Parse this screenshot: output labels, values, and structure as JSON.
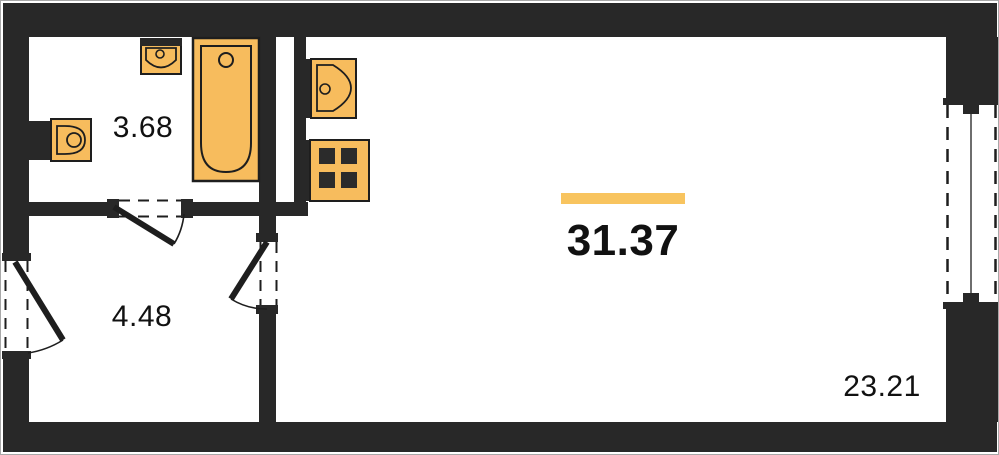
{
  "plan": {
    "name": "studio-apartment-floor-plan",
    "colors": {
      "wall": "#282828",
      "fixture_fill": "#F7BC5D",
      "fixture_stroke": "#1E1E1E",
      "accent_bar": "#F8C45F",
      "label_text": "#111111",
      "window_mullion": "#6E6E6E",
      "background": "#FFFFFF"
    },
    "labels": {
      "bathroom_area": "3.68",
      "hallway_area": "4.48",
      "main_room_area": "31.37",
      "secondary_area": "23.21"
    }
  }
}
